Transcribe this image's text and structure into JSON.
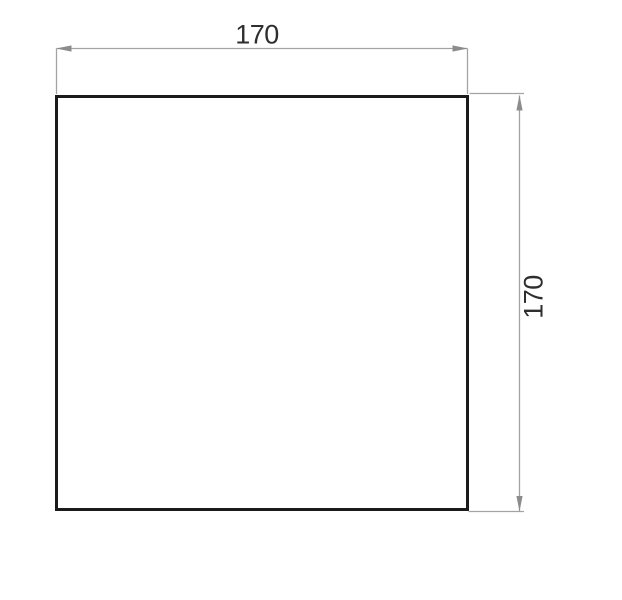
{
  "drawing": {
    "shape": "square",
    "width_dimension": {
      "label": "170"
    },
    "height_dimension": {
      "label": "170"
    }
  },
  "colors": {
    "background": "#ffffff",
    "outline": "#1b1b1b",
    "dimension_line": "#a3a3a3",
    "arrow": "#8c8c8c",
    "dimension_text": "#2e2e2e"
  }
}
